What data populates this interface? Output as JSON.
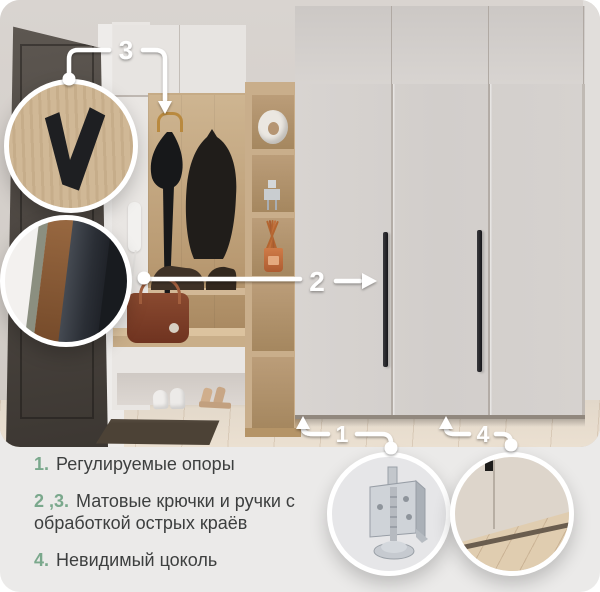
{
  "legend": {
    "items": [
      {
        "num": "1.",
        "text": "Регулируемые опоры"
      },
      {
        "num": "2 ,3.",
        "text": "Матовые крючки и ручки с обработкой острых краёв"
      },
      {
        "num": "4.",
        "text": "Невидимый цоколь"
      }
    ],
    "accent_color": "#7aa88c",
    "text_color": "#3d3f3f",
    "panel_bg": "#ebeae9"
  },
  "callouts": {
    "c1": {
      "label": "1",
      "points_to": "adjustable-supports"
    },
    "c2": {
      "label": "2",
      "points_to": "wardrobe-door-handle"
    },
    "c3": {
      "label": "3",
      "points_to": "matte-coat-hook"
    },
    "c4": {
      "label": "4",
      "points_to": "hidden-plinth"
    }
  },
  "insets": {
    "top_left": "matte-hook-closeup",
    "middle_left": "matte-handle-closeup",
    "bottom_left": "adjustable-foot-closeup",
    "bottom_right": "hidden-plinth-closeup"
  },
  "colors": {
    "callout_white": "#ffffff"
  }
}
